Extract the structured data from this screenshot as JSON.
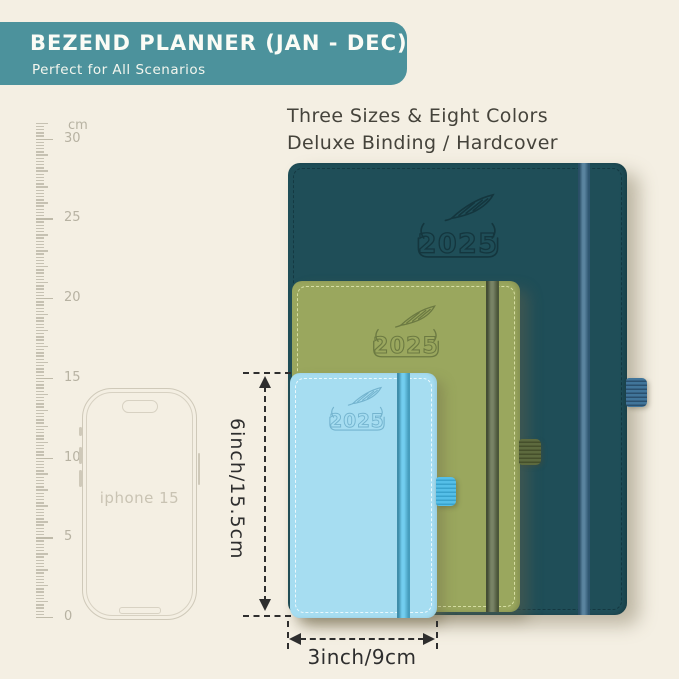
{
  "page": {
    "background": "#f4efe3"
  },
  "header": {
    "title": "BEZEND PLANNER (JAN - DEC)",
    "subtitle": "Perfect for All Scenarios",
    "bg_color": "#4c929c",
    "text_color": "#fbfcf6"
  },
  "tagline": {
    "line1": "Three Sizes & Eight Colors",
    "line2": "Deluxe Binding / Hardcover"
  },
  "ruler": {
    "unit_label": "cm",
    "tick_labels": [
      "30",
      "25",
      "20",
      "15",
      "10",
      "5",
      "0"
    ]
  },
  "phone": {
    "label": "iphone 15"
  },
  "planners": [
    {
      "name": "large",
      "year": "2025",
      "cover_color": "#1f4e58",
      "stitch_color": "#143740",
      "elastic_color": "#3a6c8d",
      "loop_color": "#41759a",
      "loop_rib_color": "#2a506e",
      "logo_color": "#14363e"
    },
    {
      "name": "medium",
      "year": "2025",
      "cover_color": "#9aa75e",
      "stitch_color": "#dde4ab",
      "elastic_color": "#5e6b48",
      "loop_color": "#5d6a3e",
      "loop_rib_color": "#454f2b",
      "logo_color": "#6c7a42"
    },
    {
      "name": "small",
      "year": "2025",
      "cover_color": "#a6ddf1",
      "stitch_color": "#f2fbfe",
      "elastic_color": "#57c4ec",
      "loop_color": "#55bfe8",
      "loop_rib_color": "#39a3cd",
      "logo_color": "#74b4cf"
    }
  ],
  "dimensions": {
    "height_label": "6inch/15.5cm",
    "width_label": "3inch/9cm"
  }
}
